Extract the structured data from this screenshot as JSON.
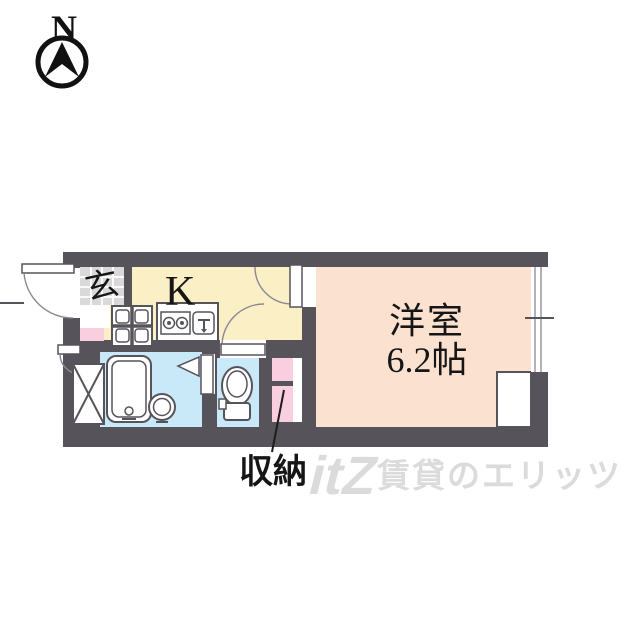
{
  "compass": {
    "label": "N"
  },
  "rooms": {
    "entrance": {
      "label": "玄"
    },
    "kitchen": {
      "label": "K"
    },
    "western_room": {
      "label": "洋室",
      "size": "6.2帖"
    },
    "storage": {
      "label": "収納"
    }
  },
  "watermark": {
    "logo": "itZ",
    "brand": "賃貸のエリッツ"
  },
  "colors": {
    "wall": "#57535B",
    "kitchen_floor": "#FAEFC5",
    "western_room_floor": "#FBE2D0",
    "wet_area_floor": "#C9E9F8",
    "storage_pink": "#F9CFE0",
    "entrance_tile": "#D9D9D9",
    "watermark_gray": "#DBDBDB"
  },
  "fixtures": {
    "bathtub": "bathtub",
    "wash_basin": "wash-basin",
    "toilet": "toilet",
    "kitchen_counter": "kitchen-counter",
    "gas_stove": "gas-stove",
    "kitchen_sink": "kitchen-sink",
    "washing_machine_pan": "washing-machine-pan",
    "pipe_shaft": "pipe-shaft",
    "closet_box": "closet-box",
    "window": "sliding-window",
    "front_door": "front-door",
    "meter_box_door": "meter-box-door"
  }
}
